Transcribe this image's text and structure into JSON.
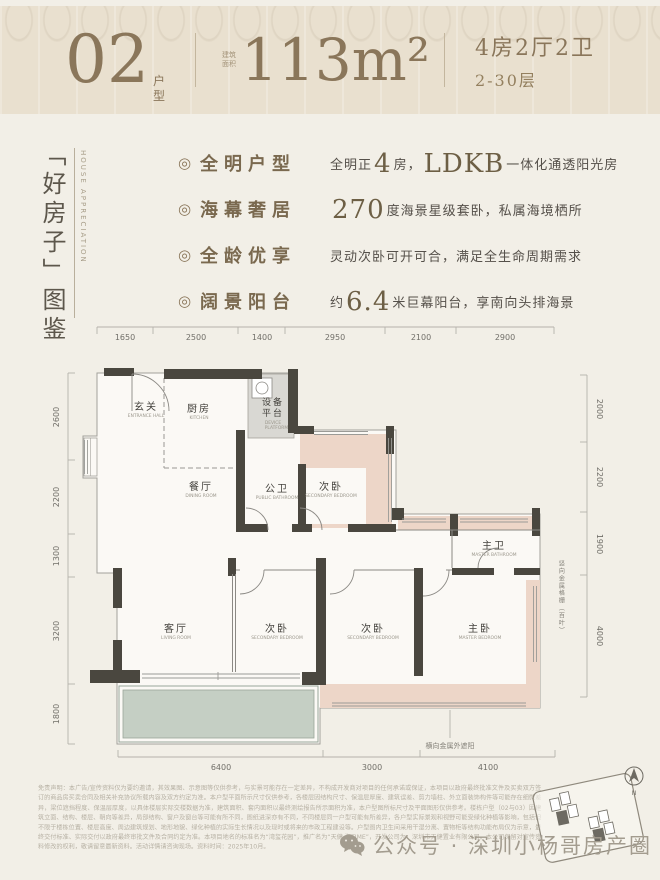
{
  "header": {
    "unit_number": "02",
    "unit_label": "户型",
    "area_prefix": "建筑面积",
    "area": "113m²",
    "rooms_line1": "4房2厅2卫",
    "rooms_line2": "2-30层"
  },
  "side_title": {
    "main": "「好房子」图鉴",
    "english": "HOUSE APPRECIATION"
  },
  "features": [
    {
      "icon": "◎",
      "label": "全明户型",
      "parts": [
        {
          "t": "全明正"
        },
        {
          "t": "4",
          "big": true
        },
        {
          "t": "房，"
        },
        {
          "t": "LDKB",
          "big": true
        },
        {
          "t": "一体化通透阳光房"
        }
      ]
    },
    {
      "icon": "◎",
      "label": "海幕奢居",
      "parts": [
        {
          "t": "270",
          "big": true
        },
        {
          "t": "度海景星级套卧，私属海境栖所"
        }
      ]
    },
    {
      "icon": "◎",
      "label": "全龄优享",
      "parts": [
        {
          "t": "灵动次卧可开可合，满足全生命周期需求"
        }
      ]
    },
    {
      "icon": "◎",
      "label": "阔景阳台",
      "parts": [
        {
          "t": "约"
        },
        {
          "t": "6.4",
          "big": true
        },
        {
          "t": "米巨幕阳台，享南向头排海景"
        }
      ]
    }
  ],
  "plan": {
    "dims": {
      "top": [
        "1650",
        "2500",
        "1400",
        "2950",
        "2100",
        "2900"
      ],
      "left": [
        "2600",
        "2200",
        "1300",
        "3200",
        "1800"
      ],
      "right": [
        "2000",
        "2200",
        "1900",
        "4000"
      ],
      "bottom": [
        "6400",
        "3000",
        "4100"
      ]
    },
    "rooms": [
      {
        "zh": "玄关",
        "en": "ENTRANCE HALL"
      },
      {
        "zh": "厨房",
        "en": "KITCHEN"
      },
      {
        "zh": "设备平台",
        "en": "DEVICE PLATFORM"
      },
      {
        "zh": "餐厅",
        "en": "DINING ROOM"
      },
      {
        "zh": "公卫",
        "en": "PUBLIC BATHROOM"
      },
      {
        "zh": "次卧",
        "en": "SECONDARY BEDROOM"
      },
      {
        "zh": "主卫",
        "en": "MASTER BATHROOM"
      },
      {
        "zh": "客厅",
        "en": "LIVING ROOM"
      },
      {
        "zh": "次卧",
        "en": "SECONDARY BEDROOM"
      },
      {
        "zh": "次卧",
        "en": "SECONDARY BEDROOM"
      },
      {
        "zh": "主卧",
        "en": "MASTER BEDROOM"
      }
    ],
    "annotations": {
      "bottom": "横向金属外遮阳",
      "right": "竖向金属格栅（百叶）"
    },
    "compass": "N"
  },
  "disclaimer": "免责声明：本广告/宣传资料仅为要约邀请，其效果图、示意图等仅供参考，与实景可能存在一定差异，不构成开发商对项目的任何承诺或保证，本项目以政府最终批准文件及买卖双方签订的商品房买卖合同及相关补充协议所载内容及双方约定为准。本户型平面所示尺寸仅供参考，各楼层因结构尺寸、保温层厚度、建筑误差、剪力墙柱、外立面装饰构件等可能存在细微差异，梁位遮挡程度、保温层厚度，以具体楼层实际交楼数据为准，建筑面积、套内面积以最终测绘报告所示面积为准，本户型图所标尺寸及平面图形仅供参考。楼栋户型（02与03）因建筑立面、结构、楼层、朝向等差异，局部结构、窗户及窗台等可能有所不同，图纸进深亦有不同，不同楼层同一户型可能有所差异，各户型实际景观和视野可能受绿化种植等影响，包括但不限于楼栋位置、楼层高度、周边建筑规划、地形地貌、绿化种植的实际生长情况以及现时或将来的市政工程建设等。户型图内卫生间采用干湿分离、置物柜等结构功能布局仅为示意，最终交付标准、实际交付以政府最终审批文件及合同约定为准。本项目地名的标准名为“湾玺花园”，推广名为“天健·海TIME”，开发公司为：深圳市天健置业有限公司。本公司保留对宣传资料修改的权利，敬请留意最新资料。活动详情请咨询现场。资料时间：2025年10月。",
  "footer": {
    "watermark": "公众号 · 深圳小杨哥房产圈"
  },
  "colors": {
    "bronze": "#8a765a",
    "wall": "#4a473f",
    "bedroom_pink": "#edd6c8",
    "balcony_green": "#c5cfc4",
    "header_bg": "#e9e0cf"
  }
}
